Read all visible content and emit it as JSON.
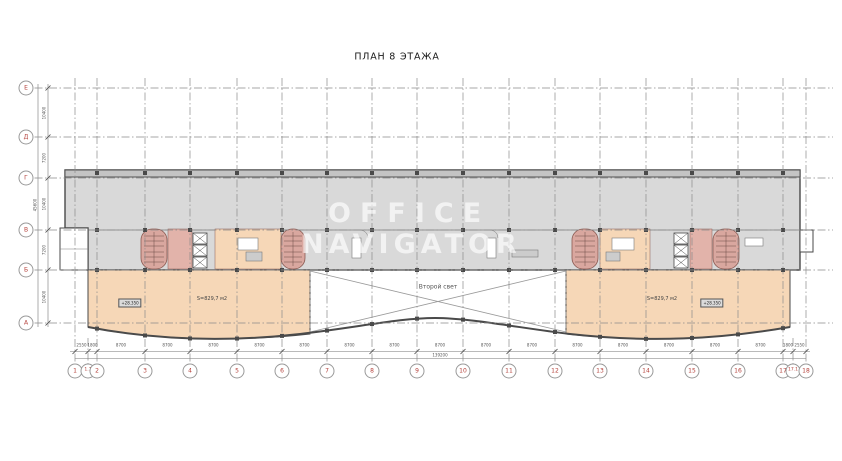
{
  "title": "ПЛАН 8 ЭТАЖА",
  "watermark": {
    "line1": "OFFICE",
    "line2": "NAVIGATOR"
  },
  "labels": {
    "void": "Второй свет",
    "left_area": "S=829,7 м2",
    "left_elevation": "+28.350",
    "right_area": "S=829,7 м2",
    "right_elevation": "+28.350"
  },
  "grid": {
    "columns": [
      {
        "label": "1",
        "x": 75
      },
      {
        "label": "1.1",
        "x": 88
      },
      {
        "label": "2",
        "x": 97
      },
      {
        "label": "3",
        "x": 145
      },
      {
        "label": "4",
        "x": 190
      },
      {
        "label": "5",
        "x": 237
      },
      {
        "label": "6",
        "x": 282
      },
      {
        "label": "7",
        "x": 327
      },
      {
        "label": "8",
        "x": 372
      },
      {
        "label": "9",
        "x": 417
      },
      {
        "label": "10",
        "x": 463
      },
      {
        "label": "11",
        "x": 509
      },
      {
        "label": "12",
        "x": 555
      },
      {
        "label": "13",
        "x": 600
      },
      {
        "label": "14",
        "x": 646
      },
      {
        "label": "15",
        "x": 692
      },
      {
        "label": "16",
        "x": 738
      },
      {
        "label": "17",
        "x": 783
      },
      {
        "label": "17.1",
        "x": 793
      },
      {
        "label": "18",
        "x": 806
      }
    ],
    "column_dims": [
      "2550",
      "1800",
      "8700",
      "8700",
      "8700",
      "8700",
      "8700",
      "8700",
      "8700",
      "8700",
      "8700",
      "8700",
      "8700",
      "8700",
      "8700",
      "8700",
      "8700",
      "1800",
      "2550"
    ],
    "rows": [
      {
        "label": "Е",
        "y": 88
      },
      {
        "label": "Д",
        "y": 137
      },
      {
        "label": "Г",
        "y": 178
      },
      {
        "label": "В",
        "y": 230
      },
      {
        "label": "Б",
        "y": 270
      },
      {
        "label": "А",
        "y": 323
      }
    ],
    "row_dims": [
      "10400",
      "7200",
      "10400",
      "7200",
      "10400"
    ],
    "total_width": "139200",
    "total_height": "45600"
  },
  "colors": {
    "axis_red": "#b4403a",
    "wall": "#4a4a4a",
    "floor_gray": "#d9d9d9",
    "floor_orange": "#f6d7b7",
    "core_pink": "#e2b3aa"
  }
}
